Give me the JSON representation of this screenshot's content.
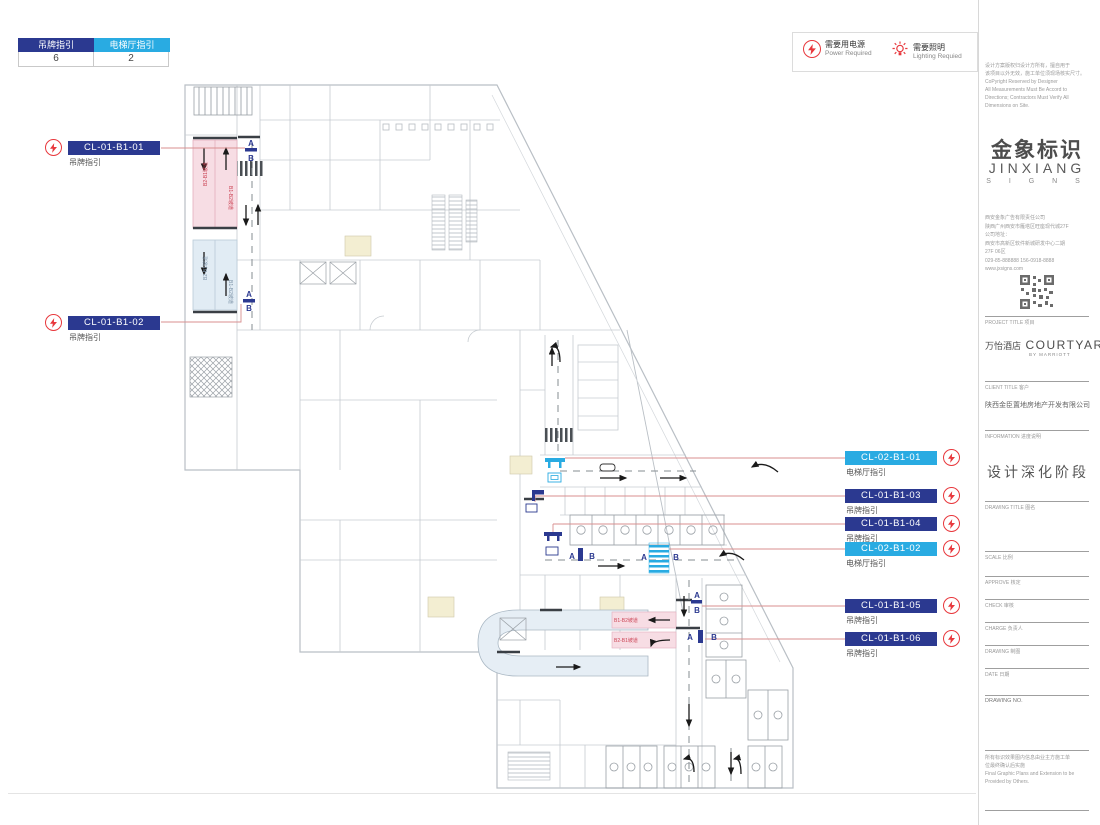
{
  "summary_table": {
    "col1_label": "吊牌指引",
    "col1_count": "6",
    "col2_label": "电梯厅指引",
    "col2_count": "2"
  },
  "legend": {
    "power_zh": "需要用电源",
    "power_en": "Power Required",
    "lighting_zh": "需要照明",
    "lighting_en": "Lighting Requied"
  },
  "labels": {
    "l1": {
      "code": "CL-01-B1-01",
      "type": "吊牌指引"
    },
    "l2": {
      "code": "CL-01-B1-02",
      "type": "吊牌指引"
    },
    "r1": {
      "code": "CL-02-B1-01",
      "type": "电梯厅指引"
    },
    "r2": {
      "code": "CL-01-B1-03",
      "type": "吊牌指引"
    },
    "r3": {
      "code": "CL-01-B1-04",
      "type": "吊牌指引"
    },
    "r4": {
      "code": "CL-02-B1-02",
      "type": "电梯厅指引"
    },
    "r5": {
      "code": "CL-01-B1-05",
      "type": "吊牌指引"
    },
    "r6": {
      "code": "CL-01-B1-06",
      "type": "吊牌指引"
    }
  },
  "plan": {
    "marker_a": "A",
    "marker_b": "B",
    "ramp_text": "B1-B2坡道",
    "ramp_text2": "B2-B1坡道"
  },
  "colors": {
    "hanging_sign": "#2b3990",
    "elevator_sign": "#29abe2",
    "accent_red": "#e8383d",
    "leader_line": "#d88f8f",
    "highlight_pink": "#f7dde4",
    "highlight_blue": "#e1ecf4"
  },
  "sidebar": {
    "copyright": [
      "设计方案版权归设计方所有，擅自用于",
      "该项目以外无效，施工单位须现场核实尺寸。",
      "CoPyright Reserved by Designer",
      "All Measurements Must Be Accord to",
      "Directions; Contractors Must Verify All",
      "Dimensions on Site."
    ],
    "logo_zh": "金象标识",
    "logo_en": "JINXIANG",
    "logo_sub": "S I G N S",
    "company": [
      "西安金象广告有限责任公司",
      "陕西广州西安市雁塔区旺座现代城27F",
      "公司地址：",
      "西安市高新区软件新城研发中心二期",
      "27F 06区",
      "029-85-888888  156-0918-8888",
      "www.jxsigns.com"
    ],
    "project_label": "PROJECT TITLE 项目",
    "project_zh": "万怡酒店",
    "project_en": "COURTYARD",
    "project_sub": "BY MARRIOTT",
    "client_label": "CLIENT TITLE 客户",
    "client_name": "陕西金臣置地房地产开发有限公司",
    "info_label": "INFORMATION 进度说明",
    "phase": "设计深化阶段",
    "drawing_title_label": "DRAWING TITLE 图名",
    "fields": [
      "SCALE 比例",
      "APPROVE 核定",
      "CHECK 审核",
      "CHARGE 负责人",
      "DRAWING 制图",
      "DATE 日期",
      "DRAWING NO."
    ],
    "footer": [
      "所有标识效果图内信息由业主方施工单",
      "位最终确认后实施",
      "Final Graphic Plans and Extension to be",
      "Provided by Others."
    ]
  }
}
